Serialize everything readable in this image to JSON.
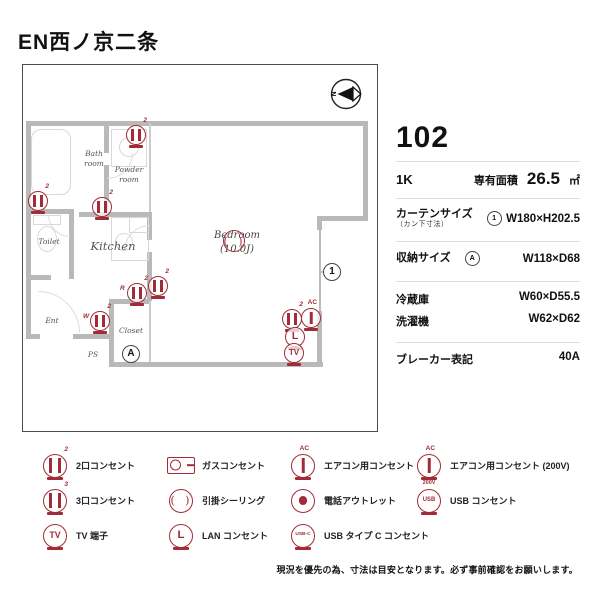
{
  "title": "EN西ノ京二条",
  "compass": {
    "n": "N"
  },
  "unit": {
    "number": "102",
    "layout": "1K",
    "area_label": "専有面積",
    "area_value": "26.5",
    "area_unit": "㎡",
    "curtain_label": "カーテンサイズ",
    "curtain_sublabel": "（カン下寸法）",
    "curtain_marker": {
      "type": "marker",
      "text": "1",
      "name": "curtain-size-marker"
    },
    "curtain_value": "W180×H202.5",
    "storage_label": "収納サイズ",
    "storage_marker": {
      "type": "marker",
      "text": "A",
      "name": "storage-size-marker"
    },
    "storage_value": "W118×D68",
    "fridge_label": "冷蔵庫",
    "fridge_value": "W60×D55.5",
    "washer_label": "洗濯機",
    "washer_value": "W62×D62",
    "breaker_label": "ブレーカー表記",
    "breaker_value": "40A"
  },
  "plan": {
    "rooms": {
      "bath": {
        "l1": "Bath",
        "l2": "room"
      },
      "powder": {
        "l1": "Powder",
        "l2": "room"
      },
      "toilet": {
        "l1": "Toilet"
      },
      "kitchen": {
        "l1": "Kitchen"
      },
      "bedroom": {
        "l1": "Bedroom",
        "l2": "(10.0J)"
      },
      "ent": {
        "l1": "Ent"
      },
      "closet": {
        "l1": "Closet"
      },
      "ps": {
        "l1": "PS"
      }
    },
    "icons": [
      {
        "type": "outlet",
        "tag": "2",
        "x": 113,
        "y": 70,
        "name": "outlet-2-powder"
      },
      {
        "type": "outlet",
        "tag": "2",
        "x": 15,
        "y": 136,
        "name": "outlet-2-toilet"
      },
      {
        "type": "outlet",
        "tag": "2",
        "x": 79,
        "y": 142,
        "name": "outlet-2-kitchen"
      },
      {
        "type": "outlet",
        "tag": "2",
        "side": "R",
        "x": 114,
        "y": 228,
        "name": "outlet-2-fridge"
      },
      {
        "type": "outlet",
        "tag": "2",
        "x": 135,
        "y": 221,
        "name": "outlet-2-bedroom-west"
      },
      {
        "type": "outlet",
        "tag": "2",
        "side": "W",
        "x": 77,
        "y": 256,
        "name": "outlet-2-washer"
      },
      {
        "type": "outlet",
        "tag": "2",
        "x": 269,
        "y": 254,
        "name": "outlet-2-bedroom-east"
      },
      {
        "type": "ac",
        "tag": "AC",
        "x": 288,
        "y": 253,
        "name": "ac-outlet"
      },
      {
        "type": "lan",
        "text": "L",
        "x": 272,
        "y": 272,
        "name": "lan-outlet"
      },
      {
        "type": "tv",
        "text": "TV",
        "x": 271,
        "y": 288,
        "name": "tv-terminal"
      },
      {
        "type": "ceiling",
        "x": 211,
        "y": 176,
        "name": "ceiling-light"
      },
      {
        "type": "marker",
        "text": "1",
        "x": 309,
        "y": 207,
        "name": "curtain-marker-1"
      },
      {
        "type": "marker",
        "text": "A",
        "x": 108,
        "y": 289,
        "name": "storage-marker-a"
      }
    ]
  },
  "legend": {
    "columns": [
      {
        "items": [
          {
            "icon": {
              "type": "outlet",
              "tag": "2",
              "name": "outlet-2"
            },
            "label": "2口コンセント"
          },
          {
            "icon": {
              "type": "outlet",
              "tag": "3",
              "name": "outlet-3"
            },
            "label": "3口コンセント"
          },
          {
            "icon": {
              "type": "tv",
              "text": "TV",
              "name": "tv-terminal"
            },
            "label": "TV 端子"
          }
        ]
      },
      {
        "items": [
          {
            "icon": {
              "type": "gas",
              "name": "gas-outlet"
            },
            "label": "ガスコンセント"
          },
          {
            "icon": {
              "type": "ceiling",
              "name": "ceiling-light"
            },
            "label": "引掛シーリング"
          },
          {
            "icon": {
              "type": "lan",
              "text": "L",
              "name": "lan-outlet"
            },
            "label": "LAN コンセント"
          }
        ]
      },
      {
        "items": [
          {
            "icon": {
              "type": "ac",
              "tag": "AC",
              "name": "ac-outlet"
            },
            "label": "エアコン用コンセント"
          },
          {
            "icon": {
              "type": "phone",
              "name": "phone-outlet"
            },
            "label": "電話アウトレット"
          },
          {
            "icon": {
              "type": "usbc",
              "text": "USB-C",
              "name": "usb-type-c-outlet"
            },
            "label": "USB タイプ C コンセント"
          }
        ]
      },
      {
        "items": [
          {
            "icon": {
              "type": "ac",
              "tag": "AC",
              "tag2": "200V",
              "name": "ac-200v-outlet"
            },
            "label": "エアコン用コンセント (200V)"
          },
          {
            "icon": {
              "type": "usb",
              "text": "USB",
              "name": "usb-outlet"
            },
            "label": "USB コンセント"
          }
        ]
      }
    ]
  },
  "disclaimer": "現況を優先の為、寸法は目安となります。必ず事前確認をお願いします。"
}
